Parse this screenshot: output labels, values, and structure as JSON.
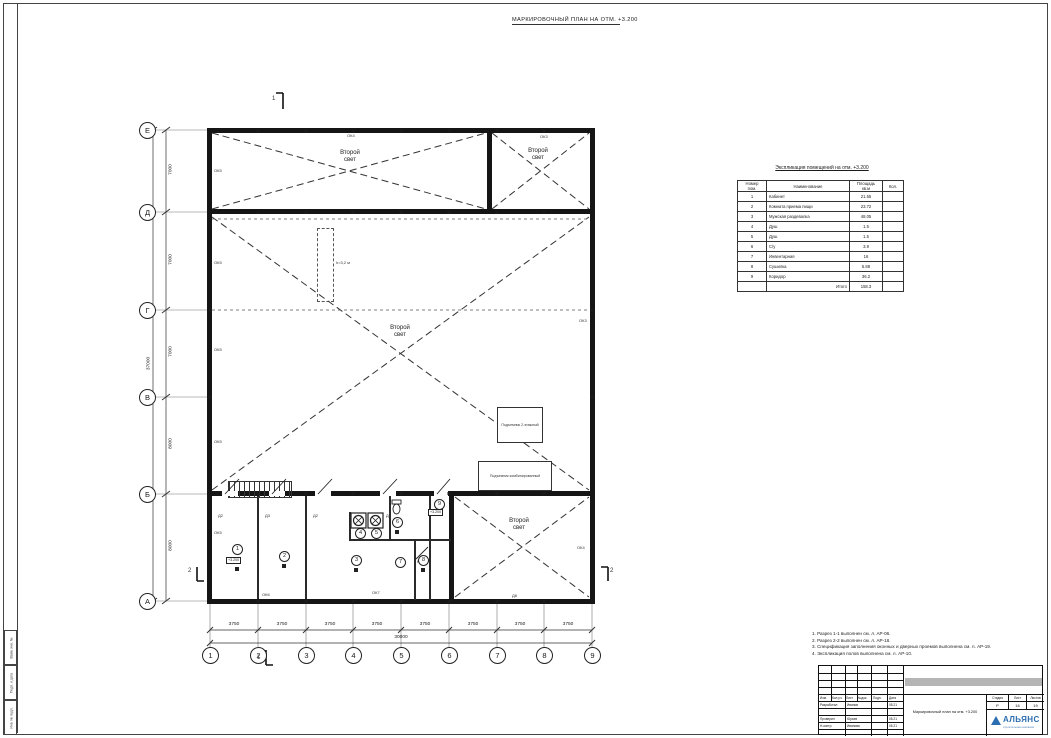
{
  "sheet_title": "МАРКИРОВОЧНЫЙ ПЛАН НА ОТМ. +3.200",
  "plan": {
    "second_light": "Второй\nсвет",
    "level_mark": "+3.200",
    "duct_label": "h=3,2 м",
    "equipment_box_1": "Подъемник 2-этажный",
    "equipment_box_2": "Подъемник комбинированный",
    "axes_rows": [
      "Е",
      "Д",
      "Г",
      "В",
      "Б",
      "А"
    ],
    "axes_cols": [
      "1",
      "2",
      "3",
      "4",
      "5",
      "6",
      "7",
      "8",
      "9"
    ],
    "dims_left": [
      "7000",
      "7000",
      "7000",
      "8000",
      "8000"
    ],
    "dims_left_total": "37000",
    "dims_bottom": [
      "3750",
      "3750",
      "3750",
      "3750",
      "3750",
      "3750",
      "3750",
      "3750"
    ],
    "dims_bottom_total": "30000",
    "tags": {
      "ok3": "ОК3",
      "ok4": "ОК4",
      "ok5": "ОК5",
      "ok6": "ОК6",
      "ok7": "ОК7",
      "d8": "Д8",
      "d2": "Д2",
      "d3": "Д3"
    },
    "room_numbers": [
      "1",
      "2",
      "3",
      "4",
      "5",
      "6",
      "7",
      "8",
      "9"
    ],
    "section_1": "1",
    "section_2": "2"
  },
  "schedule": {
    "title": "Экспликация помещений на отм. +3.200",
    "col_num": "Номер\nпом.",
    "col_name": "Наименование",
    "col_area": "Площадь\nкв.м",
    "col_qty": "Кол.",
    "rows": [
      {
        "num": "1",
        "name": "Кабинет",
        "area": "21.55"
      },
      {
        "num": "2",
        "name": "Комната приема пищи",
        "area": "23.72"
      },
      {
        "num": "3",
        "name": "Мужская раздевалка",
        "area": "48.05"
      },
      {
        "num": "4",
        "name": "Душ",
        "area": "1.5"
      },
      {
        "num": "5",
        "name": "Душ",
        "area": "1.5"
      },
      {
        "num": "6",
        "name": "С/у",
        "area": "3.9"
      },
      {
        "num": "7",
        "name": "Инвентарная",
        "area": "16"
      },
      {
        "num": "8",
        "name": "Сушилка",
        "area": "5.88"
      },
      {
        "num": "9",
        "name": "Коридор",
        "area": "36.2"
      }
    ],
    "total_label": "Итого",
    "total_value": "158.3"
  },
  "notes": {
    "line1": "1. Разрез 1-1 выполнен см. л. АР-06.",
    "line2": "2. Разрез 2-2 выполнен см. л. АР-18.",
    "line3": "3. Спецификация заполнения оконных и дверных проемов выполнена см. л. АР-19.",
    "line4": "4. Экспликация полов выполнена см. л. АР-10."
  },
  "titleblock": {
    "h_izm": "Изм.",
    "h_kol": "Кол.уч.",
    "h_list": "Лист",
    "h_doc": "№док.",
    "h_podp": "Подп.",
    "h_data": "Дата",
    "r1_role": "Разработал",
    "r1_name": "Иванов",
    "r1_date": "05.21",
    "r2_role": "Проверил",
    "r2_name": "Юрьев",
    "r2_date": "05.21",
    "r3_role": "Н.контр.",
    "r3_name": "Иванова",
    "r3_date": "05.21",
    "doc_title": "Маркировочный план на отм. +3.200",
    "stage_label": "Стадия",
    "list_label": "Лист",
    "listov_label": "Листов",
    "stage": "Р",
    "list": "16",
    "listov": "19",
    "logo": "АЛЬЯНС",
    "logo_sub": "строительная компания"
  },
  "sidebar": {
    "cell1": "Взам. инв. №",
    "cell2": "Подп. и дата",
    "cell3": "Инв. № подл."
  }
}
